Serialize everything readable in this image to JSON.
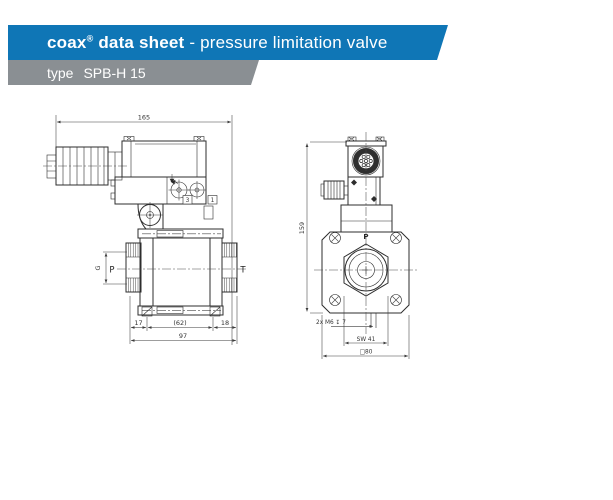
{
  "header": {
    "banner": {
      "brand": "coax",
      "registered_mark": "®",
      "title_bold_rest": " data sheet",
      "title_regular": " - pressure limitation valve"
    },
    "type_banner": {
      "label": "type",
      "value": "SPB-H 15"
    }
  },
  "side_view": {
    "labels": {
      "overall_length": "165",
      "port_inlet": "P",
      "port_outlet": "T",
      "thread": "G",
      "callout_3": "3",
      "callout_1": "1",
      "dim_17": "17",
      "dim_62": "(62)",
      "dim_18": "18",
      "dim_97": "97"
    }
  },
  "front_view": {
    "labels": {
      "overall_height": "159",
      "port_top": "P",
      "tapped_holes": "2x M6 ↧ 7",
      "wrench_size": "SW 41",
      "flange_square": "□80"
    }
  },
  "colors": {
    "banner_blue": "#0f76b6",
    "banner_gray": "#8a8f93",
    "banner_text": "#ffffff",
    "line_color": "#2d2d2d"
  }
}
